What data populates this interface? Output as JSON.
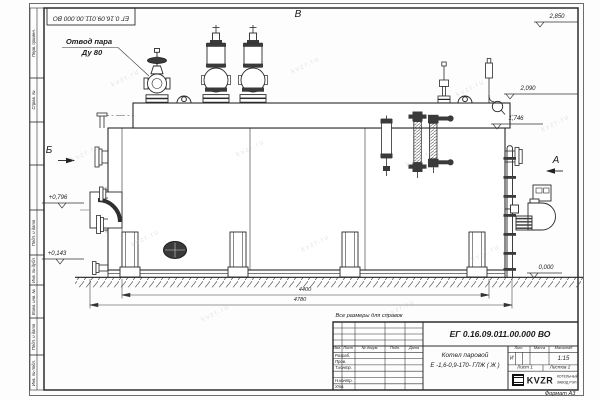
{
  "watermark": "kvzr.ru",
  "annotations": {
    "steam_outlet_line1": "Отвод пара",
    "steam_outlet_line2": "Ду 80",
    "reference_note": "Все размеры для справок",
    "view_a": "А",
    "view_b": "Б",
    "view_v": "В"
  },
  "elevations": {
    "top": "2,850",
    "drum": "2,090",
    "gauge": "1,746",
    "burner_axis": "+0,796",
    "manhole": "+0,143",
    "ground": "0,000"
  },
  "dimensions": {
    "legs_span": "4400",
    "overall_length": "4780"
  },
  "corner_stamp": "ЕГ 0.16.09.011.00.000 ВО",
  "side_column": [
    "Перв. примен.",
    "Справ. №",
    "Подп. и дата",
    "Инв. № дубл.",
    "Взам. инв. №",
    "Подп. и дата",
    "Инв. № подл."
  ],
  "title_block": {
    "doc_number": "ЕГ 0.16.09.011.00.000  ВО",
    "name_line1": "Котел паровой",
    "name_line2": "Е -1,6-0,9-170- ГЛЖ ( Ж )",
    "header_cols": {
      "izm": "Изм.",
      "list": "Лист",
      "doc": "№ докум.",
      "podp": "Подп.",
      "data": "Дата"
    },
    "rows": [
      "Разраб.",
      "Пров.",
      "Т.контр.",
      "",
      "Н.контр.",
      "Утв."
    ],
    "lit_label": "Лит.",
    "mass_label": "Масса",
    "scale_label": "Масштаб",
    "litera": "И",
    "scale": "1:15",
    "sheet": "Лист 1",
    "sheets": "Листов 2",
    "logo": "KVZR",
    "company_line1": "КОТЕЛЬНЫЙ",
    "company_line2": "ЗАВОД РЭП",
    "format": "Формат А3"
  }
}
